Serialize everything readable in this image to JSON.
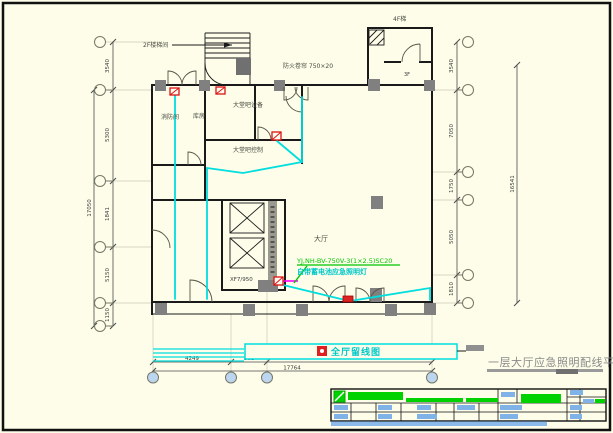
{
  "colors": {
    "paper": "#fdfdea",
    "line_black": "#1a1a1a",
    "wire_cyan": "#00dede",
    "annotation_green": "#00c400",
    "device_red": "#dd1111",
    "link_magenta": "#ff00ff",
    "title_gray": "#8a8a8a",
    "table_blue": "#7fb3e8",
    "bubble_blue": "#bcd6f0"
  },
  "sheet": {
    "drawing_title": "一层大厅应急照明配线平面图"
  },
  "plan": {
    "labels": {
      "stair_note": "2F楼梯间",
      "lintel_note": "防火卷帘 750×20",
      "upper_stair_note": "4F梯",
      "room_3f": "3F",
      "room_fire": "消防间",
      "room_store": "库房",
      "room_lobby_equip": "大堂吧设备",
      "room_lobby_ctrl": "大堂吧控制",
      "hall": "大厅",
      "elevator": "XF7/950",
      "wire_spec": "YJ,NH-BV-750V-3(1×2.5)SC20",
      "wire_note": "自带蓄电池应急照明灯",
      "reserve_label": "全厅留线图"
    },
    "dims": {
      "left": [
        "3540",
        "5300",
        "1841",
        "5150",
        "1150"
      ],
      "left_total": "17050",
      "right": [
        "3540",
        "7050",
        "1750",
        "5050",
        "1810"
      ],
      "right_total": "16541",
      "bottom": [
        "4249",
        "861"
      ],
      "bottom_total": "17764"
    }
  }
}
